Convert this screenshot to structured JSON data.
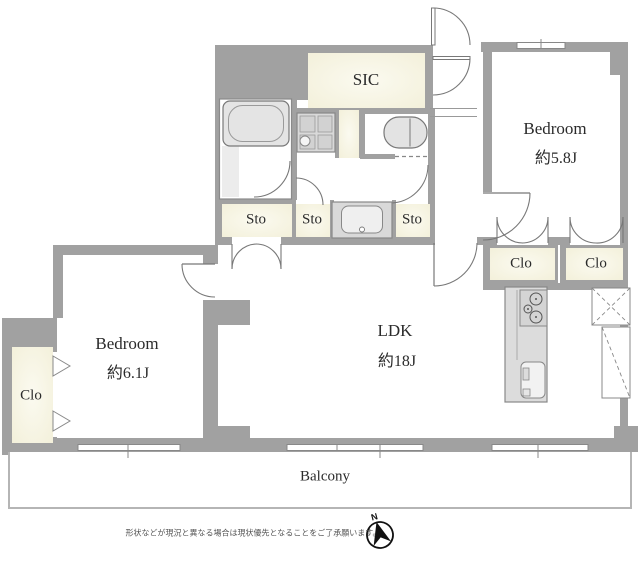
{
  "rooms": {
    "sic": {
      "label": "SIC"
    },
    "bedroom_right": {
      "label": "Bedroom",
      "area": "約5.8J"
    },
    "bedroom_left": {
      "label": "Bedroom",
      "area": "約6.1J"
    },
    "ldk": {
      "label": "LDK",
      "area": "約18J"
    },
    "balcony": {
      "label": "Balcony"
    }
  },
  "storage": {
    "sto_bath": {
      "label": "Sto"
    },
    "sto_hall": {
      "label": "Sto"
    },
    "sto_right": {
      "label": "Sto"
    },
    "clo_right_1": {
      "label": "Clo"
    },
    "clo_right_2": {
      "label": "Clo"
    },
    "clo_left": {
      "label": "Clo"
    }
  },
  "compass": {
    "north_label": "N"
  },
  "footer": {
    "disclaimer": "形状などが現況と異なる場合は現状優先となることをご了承願います。"
  },
  "colors": {
    "wall": "#a1a1a1",
    "closet_fill": "#f5f3e1",
    "fixture_fill": "#dcdcdc",
    "line": "#7d7d7d"
  }
}
